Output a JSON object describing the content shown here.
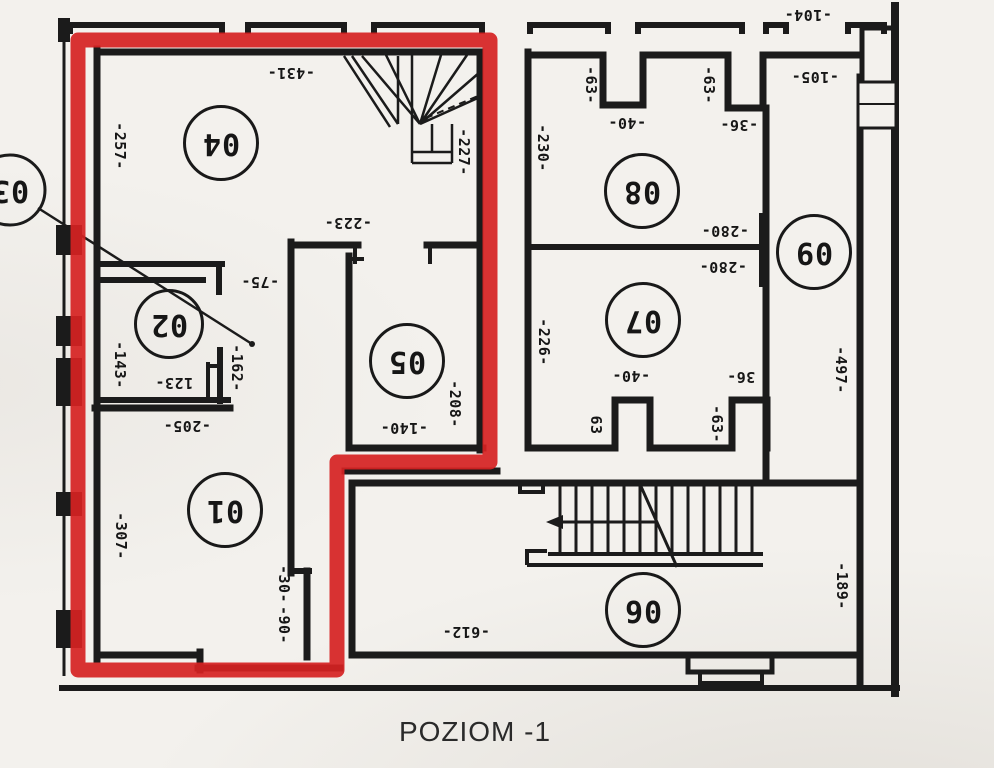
{
  "caption": "POZIOM -1",
  "palette": {
    "highlight_red": "#d62222",
    "ink": "#1b1b1b",
    "paper": "#f3f1ed"
  },
  "highlighted_rooms": [
    "01",
    "02",
    "04",
    "05"
  ],
  "rooms": [
    {
      "number": "01"
    },
    {
      "number": "02"
    },
    {
      "number": "03"
    },
    {
      "number": "04"
    },
    {
      "number": "05"
    },
    {
      "number": "06"
    },
    {
      "number": "07"
    },
    {
      "number": "08"
    },
    {
      "number": "09"
    }
  ],
  "dimensions": [
    {
      "text": "-431-"
    },
    {
      "text": "-257-"
    },
    {
      "text": "-227-"
    },
    {
      "text": "-223-"
    },
    {
      "text": "-75-"
    },
    {
      "text": "-143-"
    },
    {
      "text": "123-"
    },
    {
      "text": "-162-"
    },
    {
      "text": "-205-"
    },
    {
      "text": "-140-"
    },
    {
      "text": "-208-"
    },
    {
      "text": "-307-"
    },
    {
      "text": "-30-"
    },
    {
      "text": "-90-"
    },
    {
      "text": "-612-"
    },
    {
      "text": "-104-"
    },
    {
      "text": "-63-"
    },
    {
      "text": "-40-"
    },
    {
      "text": "-63-"
    },
    {
      "text": "-36-"
    },
    {
      "text": "-105-"
    },
    {
      "text": "-230-"
    },
    {
      "text": "-280-"
    },
    {
      "text": "-280-"
    },
    {
      "text": "-226-"
    },
    {
      "text": "-40-"
    },
    {
      "text": "63"
    },
    {
      "text": "-63-"
    },
    {
      "text": "36-"
    },
    {
      "text": "-497-"
    },
    {
      "text": "-189-"
    }
  ]
}
